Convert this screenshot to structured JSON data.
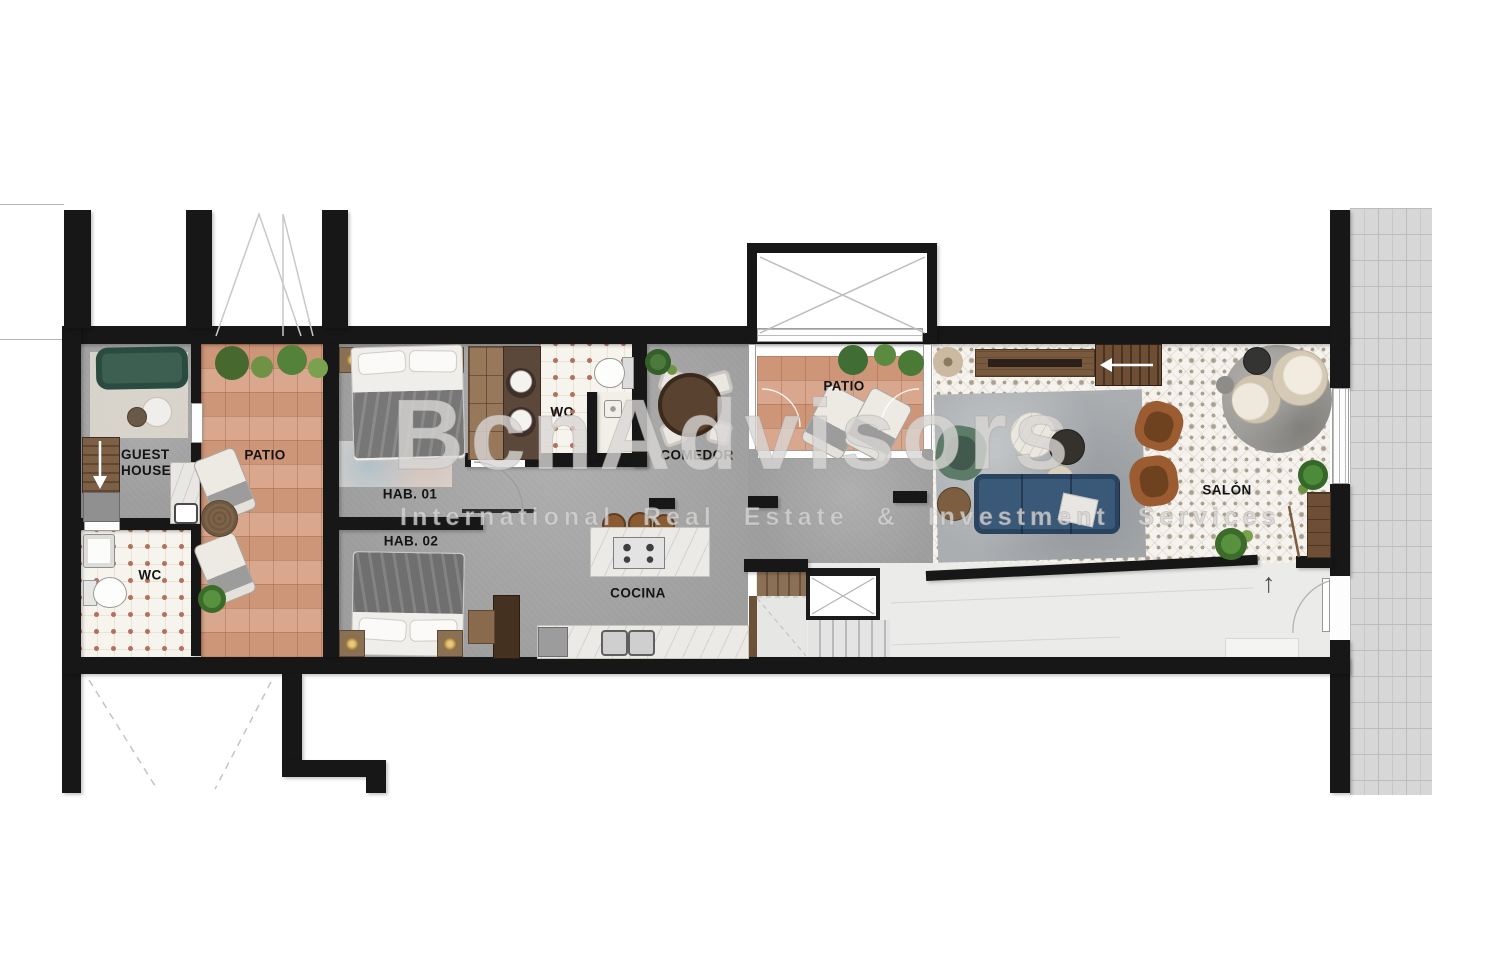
{
  "watermark": {
    "brand": "BcnAdvisors",
    "tagline": "International Real Estate & Investment Services"
  },
  "rooms": {
    "guest_house": {
      "label": "GUEST HOUSE"
    },
    "wc_guest": {
      "label": "WC"
    },
    "patio_left": {
      "label": "PATIO"
    },
    "hab_01": {
      "label": "HAB. 01"
    },
    "hab_02": {
      "label": "HAB. 02"
    },
    "wc_main": {
      "label": "WC"
    },
    "comedor": {
      "label": "COMEDOR"
    },
    "cocina": {
      "label": "COCINA"
    },
    "patio_right": {
      "label": "PATIO"
    },
    "salon": {
      "label": "SALÓN"
    }
  },
  "symbols": {
    "entrance_arrow": "↑"
  },
  "palette": {
    "wall": "#171717",
    "terracotta_tile": "#d59d80",
    "concrete_floor": "#a5a5a6",
    "salon_tile": "#f6f3ee",
    "dot_tile": "#f7f4ee",
    "sidewalk": "#d7d7d7",
    "sofa_blue": "#3a5878",
    "sofa_green": "#3c5f52",
    "leather_brown": "#9a5c30",
    "wood": "#8a6a4c",
    "watermark_gray": "#d8d6d3"
  }
}
